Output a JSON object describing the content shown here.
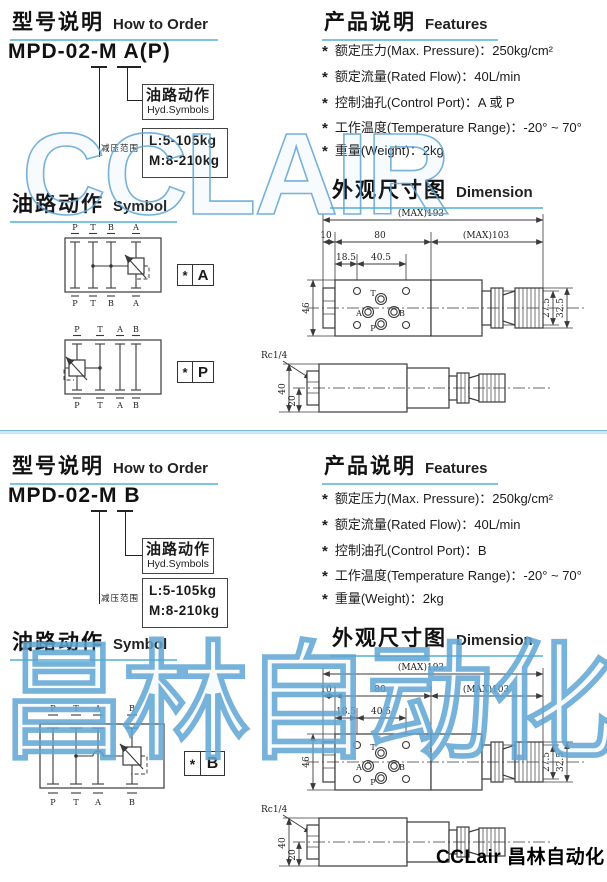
{
  "page": {
    "watermark_top": "CCLAIR",
    "watermark_bottom": "昌林自动化",
    "footer_brand": "CCLair 昌林自动化"
  },
  "section1": {
    "order": {
      "title_zh": "型号说明",
      "title_en": "How to Order",
      "model": "MPD-02-M A(P)",
      "hyd_zh": "油路动作",
      "hyd_en": "Hyd.Symbols",
      "range_label": "减压范围",
      "range_l1": "L:5-105kg",
      "range_l2": "M:8-210kg"
    },
    "features": {
      "title_zh": "产品说明",
      "title_en": "Features",
      "bullet": "*",
      "items": [
        "额定压力(Max. Pressure)：250kg/cm²",
        "额定流量(Rated Flow)：40L/min",
        "控制油孔(Control Port)：A 或 P",
        "工作温度(Temperature Range)：-20° ~ 70°",
        "重量(Weight)：2kg"
      ]
    },
    "symbol": {
      "title_zh": "油路动作",
      "title_en": "Symbol",
      "d1": {
        "ports": [
          "P",
          "T",
          "B",
          "A"
        ],
        "star": "*",
        "letter": "A"
      },
      "d2": {
        "ports": [
          "P",
          "T",
          "A",
          "B"
        ],
        "star": "*",
        "letter": "P"
      }
    },
    "dim": {
      "title_zh": "外观尺寸图",
      "title_en": "Dimension",
      "max193": "(MAX)193",
      "d10": "10",
      "d80": "80",
      "max103": "(MAX)103",
      "d185": "18.5",
      "d405": "40.5",
      "d46": "46",
      "d31": "31",
      "d275": "27.5",
      "d325": "32.5",
      "rc": "Rc1/4",
      "d40": "40",
      "d20": "20",
      "port_t": "T",
      "port_a": "A",
      "port_b": "B",
      "port_p": "P"
    }
  },
  "section2": {
    "order": {
      "title_zh": "型号说明",
      "title_en": "How to Order",
      "model": "MPD-02-M B",
      "hyd_zh": "油路动作",
      "hyd_en": "Hyd.Symbols",
      "range_label": "减压范围",
      "range_l1": "L:5-105kg",
      "range_l2": "M:8-210kg"
    },
    "features": {
      "title_zh": "产品说明",
      "title_en": "Features",
      "bullet": "*",
      "items": [
        "额定压力(Max. Pressure)：250kg/cm²",
        "额定流量(Rated Flow)：40L/min",
        "控制油孔(Control Port)：B",
        "工作温度(Temperature Range)：-20° ~ 70°",
        "重量(Weight)：2kg"
      ]
    },
    "symbol": {
      "title_zh": "油路动作",
      "title_en": "Symbol",
      "d1": {
        "ports": [
          "P",
          "T",
          "A",
          "B"
        ],
        "star": "*",
        "letter": "B"
      }
    },
    "dim": {
      "title_zh": "外观尺寸图",
      "title_en": "Dimension",
      "max193": "(MAX)193",
      "d10": "10",
      "d80": "80",
      "max103": "(MAX)103",
      "d185": "18.5",
      "d405": "40.5",
      "d46": "46",
      "d31": "31",
      "d275": "27.5",
      "d325": "32.5",
      "rc": "Rc1/4",
      "d40": "40",
      "d20": "20",
      "port_t": "T",
      "port_a": "A",
      "port_b": "B",
      "port_p": "P"
    }
  }
}
